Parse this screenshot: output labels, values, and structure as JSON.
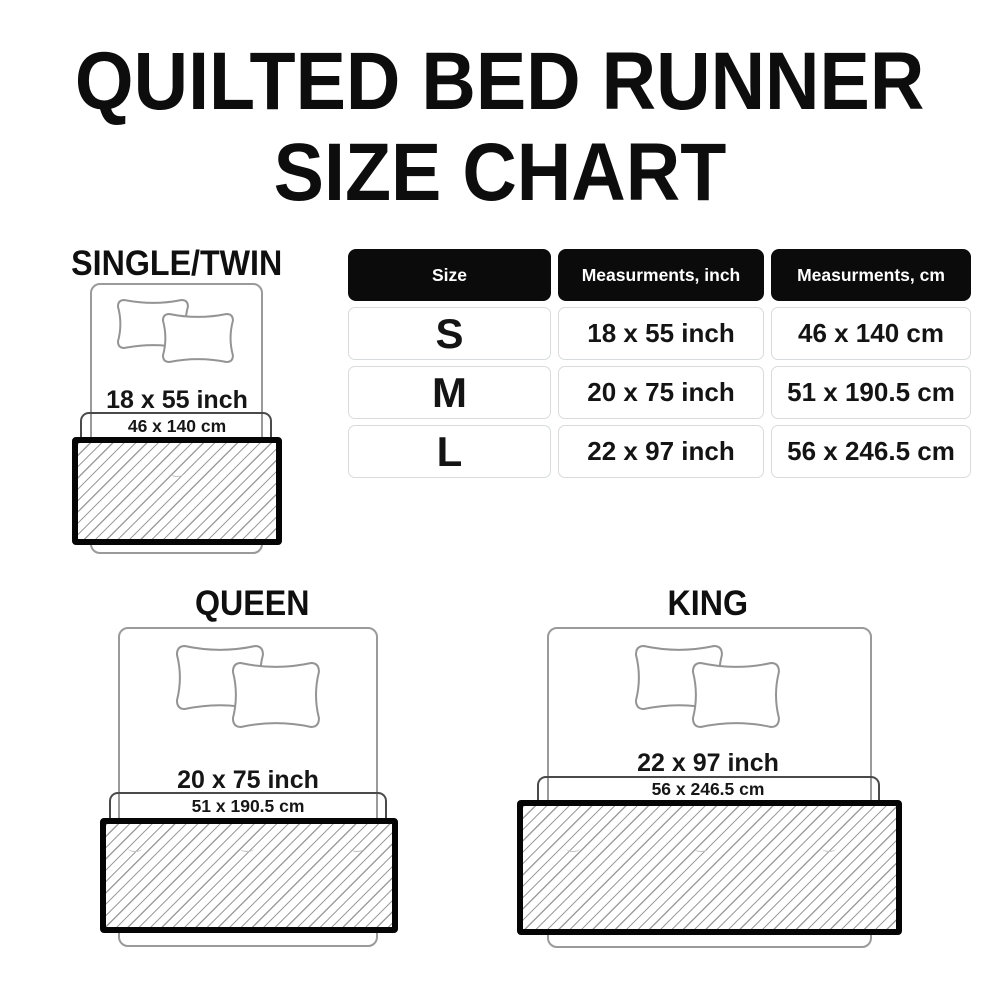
{
  "title": {
    "line1": "QUILTED BED RUNNER",
    "line2": "SIZE CHART"
  },
  "table": {
    "headers": [
      "Size",
      "Measurments, inch",
      "Measurments, cm"
    ],
    "rows": [
      {
        "size": "S",
        "inch": "18 x 55 inch",
        "cm": "46 x 140 cm"
      },
      {
        "size": "M",
        "inch": "20 x 75 inch",
        "cm": "51 x 190.5 cm"
      },
      {
        "size": "L",
        "inch": "22 x 97 inch",
        "cm": "56 x 246.5 cm"
      }
    ]
  },
  "diagrams": [
    {
      "label": "SINGLE/TWIN",
      "inch": "18 x 55 inch",
      "cm": "46 x 140 cm"
    },
    {
      "label": "QUEEN",
      "inch": "20 x 75 inch",
      "cm": "51 x 190.5 cm"
    },
    {
      "label": "KING",
      "inch": "22 x 97 inch",
      "cm": "56 x 246.5 cm"
    }
  ],
  "colors": {
    "text": "#111111",
    "table_header_bg": "#0b0b0b",
    "table_header_text": "#ffffff",
    "cell_border": "#d8dbdd",
    "bed_outline": "#9a9a9a",
    "bracket_line": "#4a4a4a",
    "runner_border": "#050505",
    "hatch_line": "#9e9e9e"
  }
}
